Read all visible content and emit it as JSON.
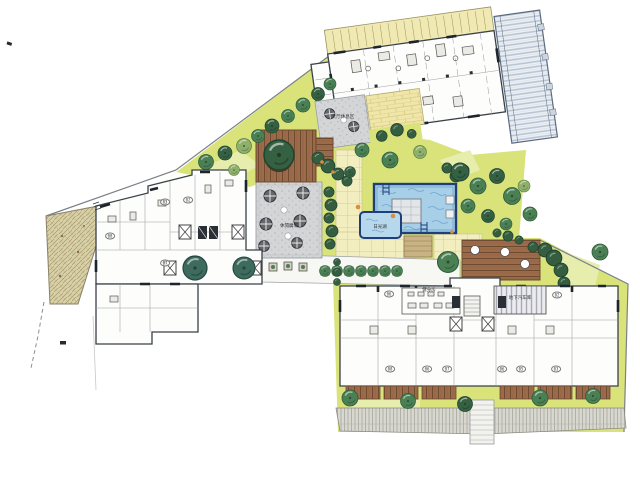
{
  "plan": {
    "labels": {
      "lobby_terrace": "大厅休息区",
      "leisure_plaza": "休閒廣場",
      "kids_pool": "日光湖",
      "gym": "健身房",
      "garage_ramp": "地下汽车库"
    },
    "unit_numbers": {
      "left_building": [
        "08",
        "03",
        "02",
        "07"
      ],
      "bottom_building_upper": [
        "06",
        "02"
      ],
      "bottom_building_lower": [
        "08",
        "06",
        "07",
        "06",
        "05",
        "03"
      ]
    },
    "colors": {
      "lawn": "#d9e37a",
      "tree_green": "#4a8054",
      "water_blue": "#a8cfe8",
      "pool_border": "#1f3f7a",
      "wood_deck": "#9c6b4a",
      "plaza_gray": "#d2d3d5",
      "paving_yellow": "#f3eec0",
      "stone_tan": "#d8d0a8",
      "wall_ink": "#3a4148"
    }
  }
}
